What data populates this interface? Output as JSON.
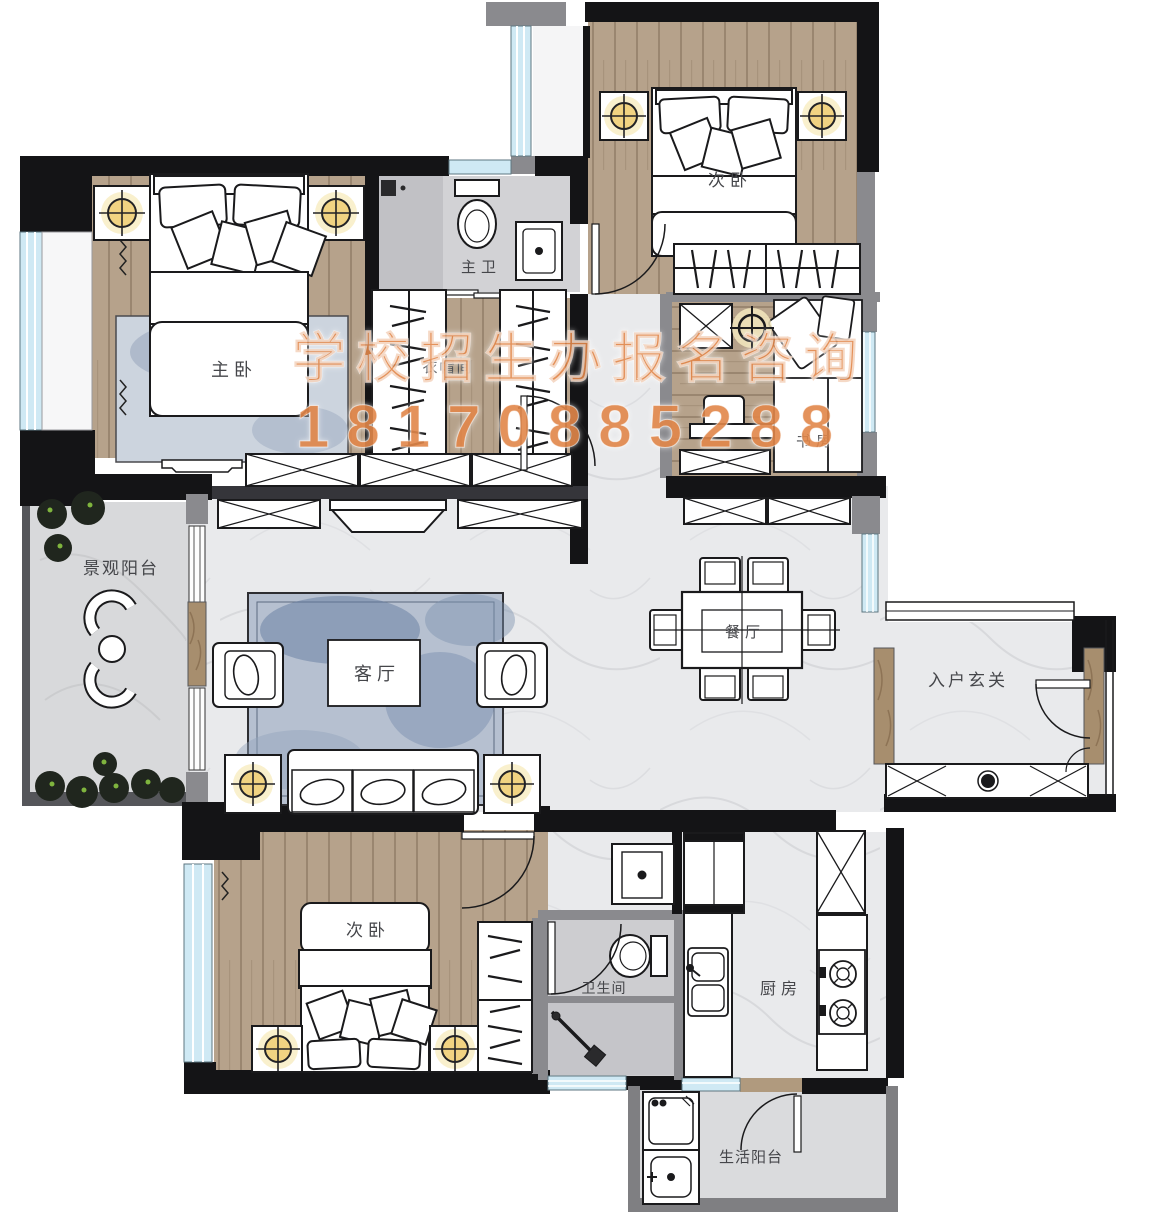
{
  "watermark": {
    "line1": "学校招生办报名咨询",
    "line2": "18170885288",
    "color": "#e2874a"
  },
  "rooms": {
    "master_bedroom": {
      "label": "主卧"
    },
    "master_bath": {
      "label": "主卫"
    },
    "cloakroom": {
      "label": "衣帽间"
    },
    "bedroom_top": {
      "label": "次卧"
    },
    "study": {
      "label": "书房"
    },
    "view_balcony": {
      "label": "景观阳台"
    },
    "living_room": {
      "label": "客厅"
    },
    "dining_room": {
      "label": "餐厅"
    },
    "entry_hall": {
      "label": "入户玄关"
    },
    "bedroom_bottom": {
      "label": "次卧"
    },
    "bathroom": {
      "label": "卫生间"
    },
    "kitchen": {
      "label": "厨房"
    },
    "service_balcony": {
      "label": "生活阳台"
    }
  },
  "palette": {
    "wall_black": "#141416",
    "wall_gray": "#8a8a8e",
    "wood": "#b5a18a",
    "marble": "#e9eaec",
    "tile": "#cdcdd0",
    "window_blue": "#cfe9f4",
    "lamp_yellow": "#f1d382",
    "rug_blue": "#8fa0ba",
    "plant_green": "#7fb43e",
    "marble_pillar": "#a78e6e",
    "watermark_orange": "#e2874a"
  }
}
